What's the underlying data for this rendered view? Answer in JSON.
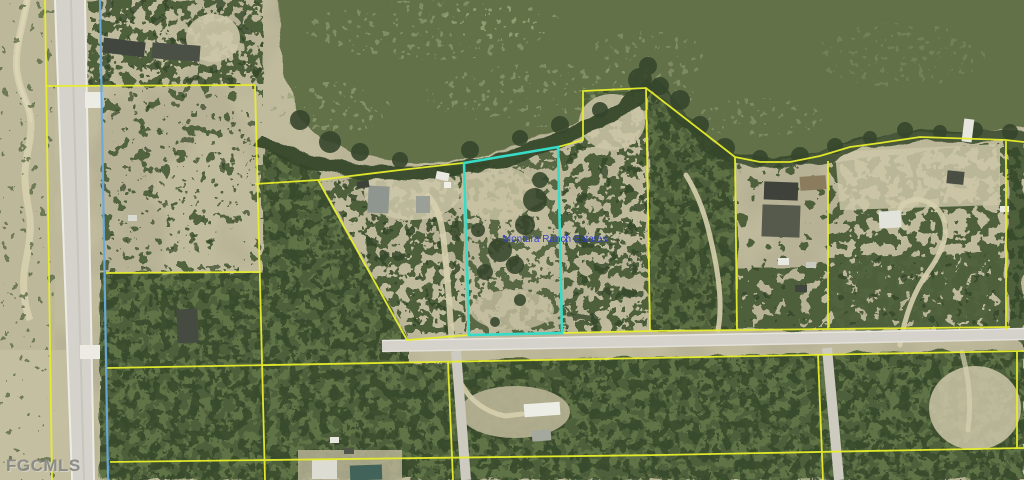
{
  "labels": {
    "parcel_name": "Montura Ranch Estates",
    "watermark": "FGCMLS"
  },
  "colors": {
    "land": "#b7b295",
    "land_light": "#cdc7a8",
    "dirt": "#d6cfae",
    "water": "#64714a",
    "algae": "#95a274",
    "tree_dark": "#36462c",
    "tree_mid": "#4d5f3a",
    "tree_light": "#6f8450",
    "road": "#d4d2ca",
    "road_edge": "#ecebe4",
    "parcel_line": "#e8ee2b",
    "boundary_blue": "#68aadd",
    "highlight": "#37dcc9",
    "label_blue": "#2f3fd0",
    "watermark": "#8b8b87"
  }
}
